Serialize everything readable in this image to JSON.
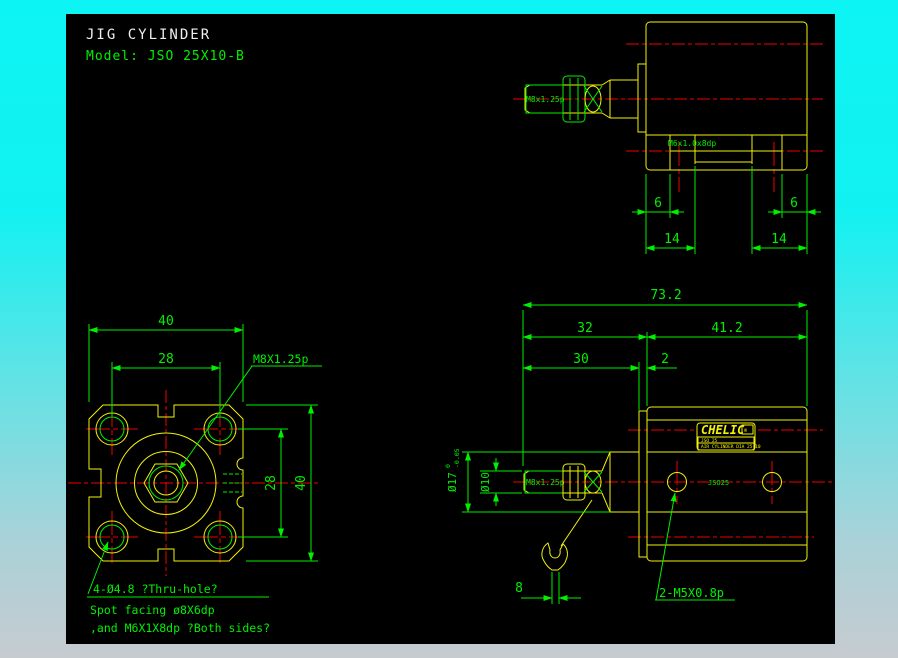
{
  "header": {
    "title": "JIG CYLINDER",
    "model": "Model:  JSO 25X10-B"
  },
  "colors": {
    "canvas_bg": "#000000",
    "part_yellow": "#f2f20a",
    "dim_green": "#00f000",
    "centerline_red": "#f00000",
    "title_white": "#efefef",
    "frame_top": "#0df4f4",
    "frame_bottom": "#c6cbd0"
  },
  "top_view": {
    "rod_thread": "M8x1.25p",
    "foot_thread": "M6x1.0x8dp",
    "dim_foot_offset_left": "6",
    "dim_foot_slot_left": "14",
    "dim_foot_offset_right": "6",
    "dim_foot_slot_right": "14"
  },
  "front_view": {
    "dim_body_width": "40",
    "dim_hole_spacing_h": "28",
    "dim_hole_spacing_v": "28",
    "dim_body_height": "40",
    "rod_thread_label": "M8X1.25p",
    "note_thru_hole": "4-Ø4.8 ?Thru-hole?",
    "note_spot_facing": "Spot facing ø8X6dp",
    "note_side_thread": ",and M6X1X8dp ?Both sides?"
  },
  "side_view": {
    "dim_overall_length": "73.2",
    "dim_front_section": "32",
    "dim_rear_section": "41.2",
    "dim_rod_extension": "30",
    "dim_plate_thickness": "2",
    "dim_collar_dia": "Ø17",
    "collar_tol_upper": "0",
    "collar_tol_lower": "-0.05",
    "dim_rod_dia": "Ø10",
    "rod_thread": "M8x1.25p",
    "dim_wrench_flat": "8",
    "port_note": "2-M5X0.8p",
    "body_marking": "JSO25",
    "nameplate": {
      "brand": "CHELIC",
      "mark": "®",
      "line1": "JSO 25",
      "line2": "AIR CYLINDER DIA 25 10"
    }
  }
}
